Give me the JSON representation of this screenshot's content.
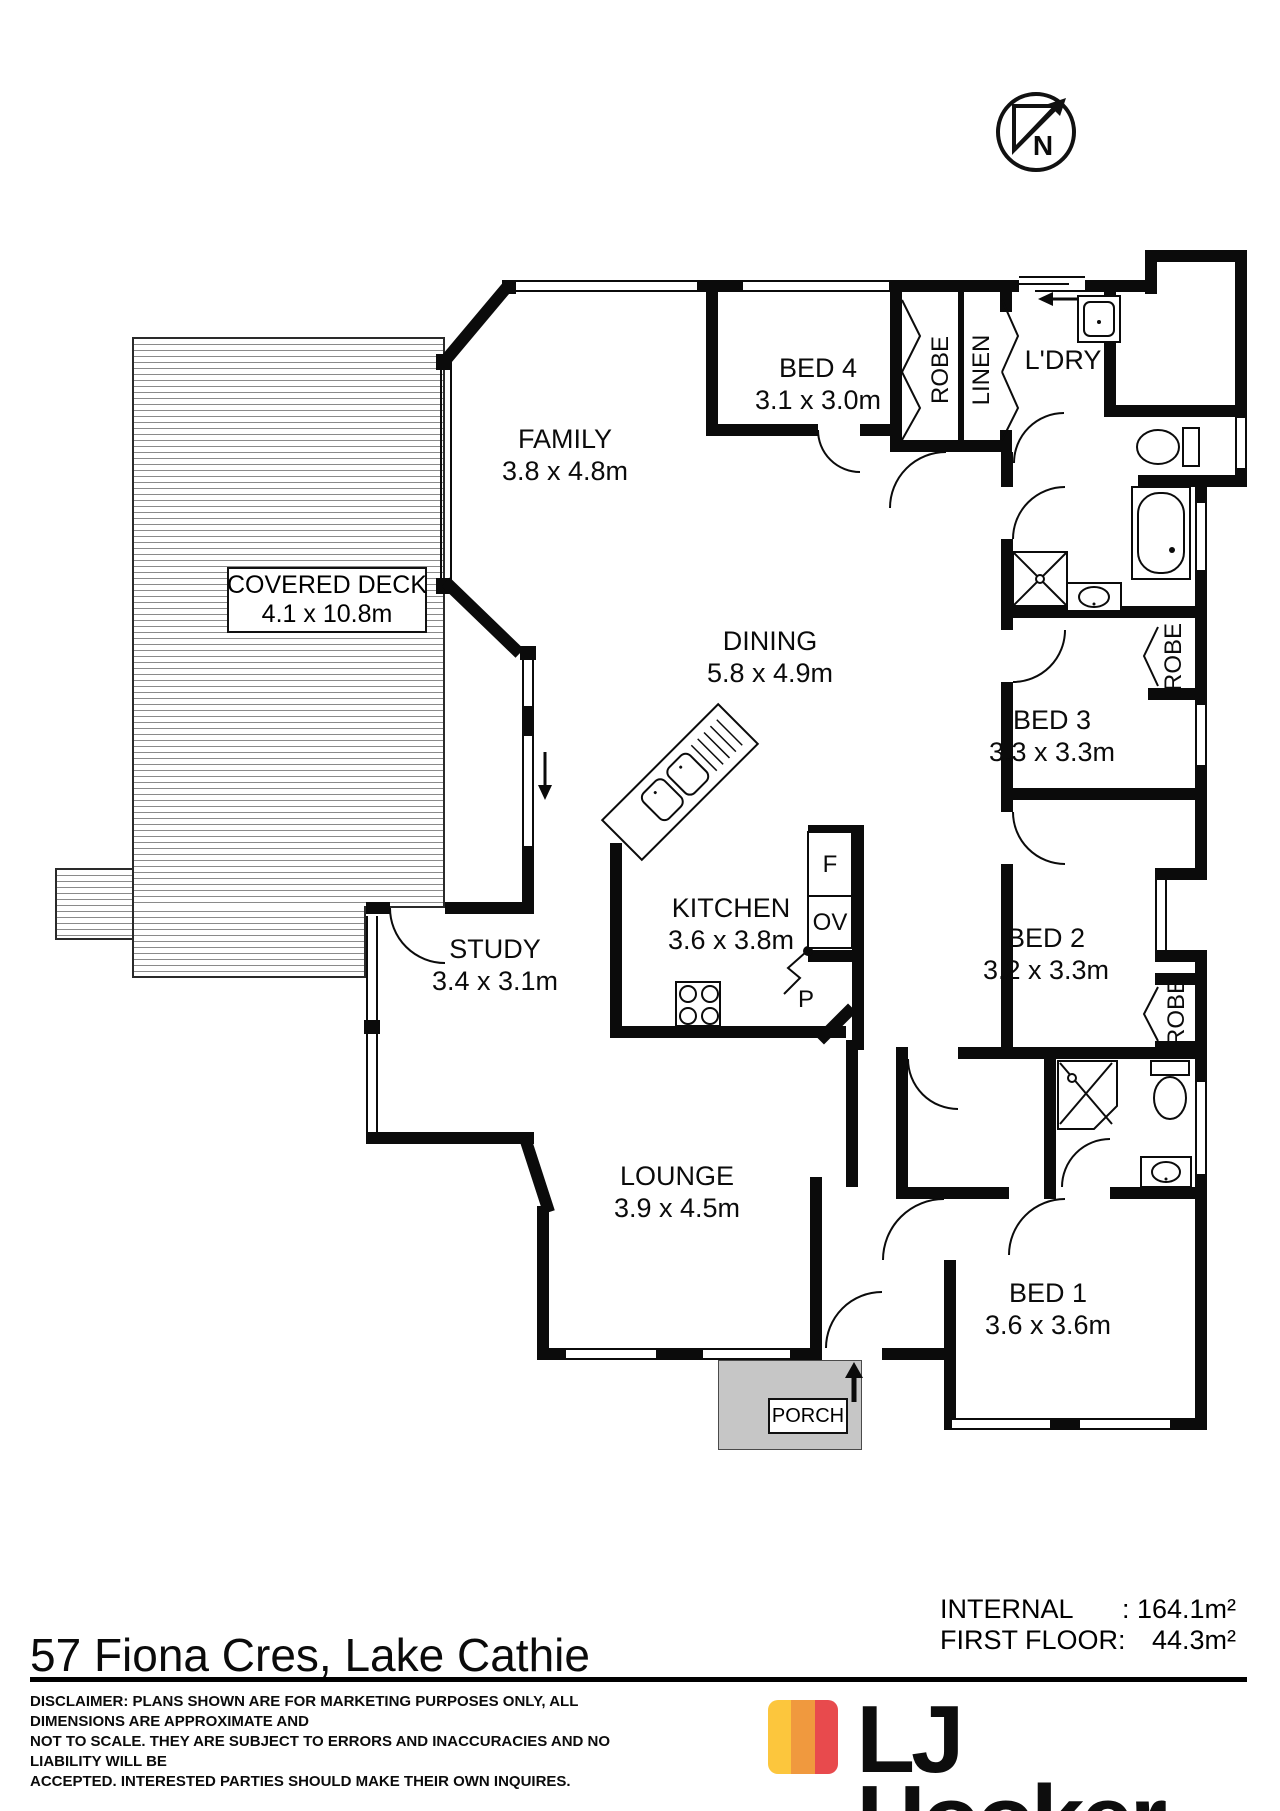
{
  "compass": {
    "label": "N"
  },
  "rooms": [
    {
      "id": "family",
      "name": "FAMILY",
      "dims": "3.8 x 4.8m"
    },
    {
      "id": "bed4",
      "name": "BED 4",
      "dims": "3.1 x 3.0m"
    },
    {
      "id": "dining",
      "name": "DINING",
      "dims": "5.8 x 4.9m"
    },
    {
      "id": "deck",
      "name": "COVERED DECK",
      "dims": "4.1 x 10.8m"
    },
    {
      "id": "bed3",
      "name": "BED 3",
      "dims": "3.3 x 3.3m"
    },
    {
      "id": "kitchen",
      "name": "KITCHEN",
      "dims": "3.6 x 3.8m"
    },
    {
      "id": "bed2",
      "name": "BED 2",
      "dims": "3.2 x 3.3m"
    },
    {
      "id": "study",
      "name": "STUDY",
      "dims": "3.4 x 3.1m"
    },
    {
      "id": "lounge",
      "name": "LOUNGE",
      "dims": "3.9 x 4.5m"
    },
    {
      "id": "bed1",
      "name": "BED 1",
      "dims": "3.6 x 3.6m"
    },
    {
      "id": "ldry",
      "name": "L'DRY"
    },
    {
      "id": "porch",
      "name": "PORCH"
    }
  ],
  "closets": {
    "robe": "ROBE",
    "linen": "LINEN"
  },
  "appliances": {
    "fridge": "F",
    "oven": "OV",
    "pantry": "P"
  },
  "areas": {
    "internal_label": "INTERNAL",
    "internal_value": ": 164.1m²",
    "first_floor_label": "FIRST FLOOR:",
    "first_floor_value": "44.3m²"
  },
  "footer": {
    "address": "57 Fiona Cres, Lake Cathie",
    "disclaimer_lines": [
      "DISCLAIMER: PLANS SHOWN ARE FOR MARKETING PURPOSES ONLY, ALL DIMENSIONS ARE APPROXIMATE AND",
      "NOT TO SCALE. THEY ARE SUBJECT TO ERRORS AND INACCURACIES AND NO LIABILITY WILL BE",
      "ACCEPTED. INTERESTED PARTIES SHOULD MAKE THEIR OWN INQUIRES."
    ]
  },
  "logo": {
    "text": "LJ Hooker",
    "colors": {
      "yellow": "#FCC63D",
      "orange": "#F0993E",
      "red": "#E84A4D"
    }
  }
}
